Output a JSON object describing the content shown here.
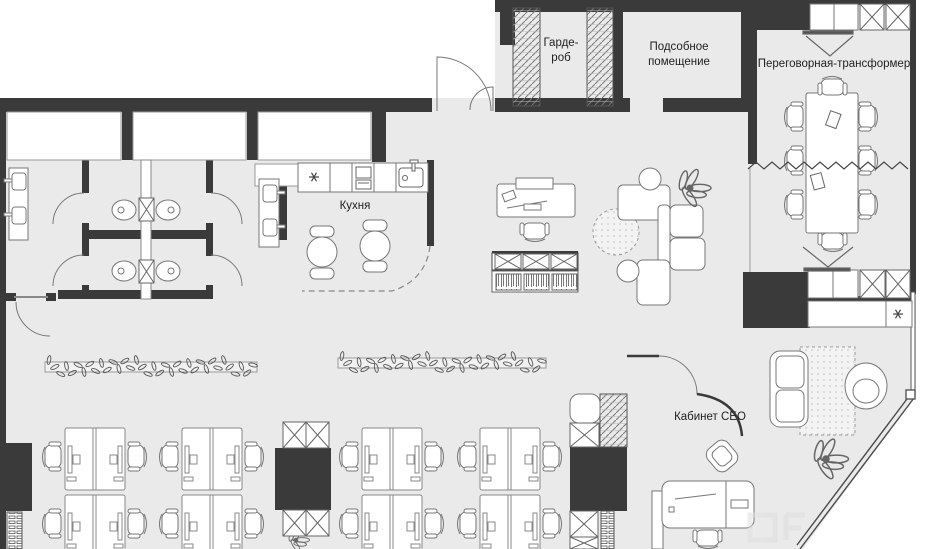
{
  "plan": {
    "rooms": {
      "wardrobe": {
        "label": "Гарде-\nроб"
      },
      "utility": {
        "label": "Подсобное\nпомещение"
      },
      "meeting": {
        "label": "Переговорная-трансформер"
      },
      "kitchen": {
        "label": "Кухня"
      },
      "ceo": {
        "label": "Кабинет CEO"
      }
    },
    "colors": {
      "wall": "#3a3a3a",
      "floor": "#eaeaea",
      "furniture_line": "#777777",
      "white": "#ffffff"
    },
    "icons": {
      "cooktop_star": "six-spoke asterisk (cooktop)",
      "appliance_star": "six-spoke asterisk (appliance)",
      "tv_screen": "presentation screen with view lines",
      "zigzag_partition": "folding transformer partition"
    }
  }
}
